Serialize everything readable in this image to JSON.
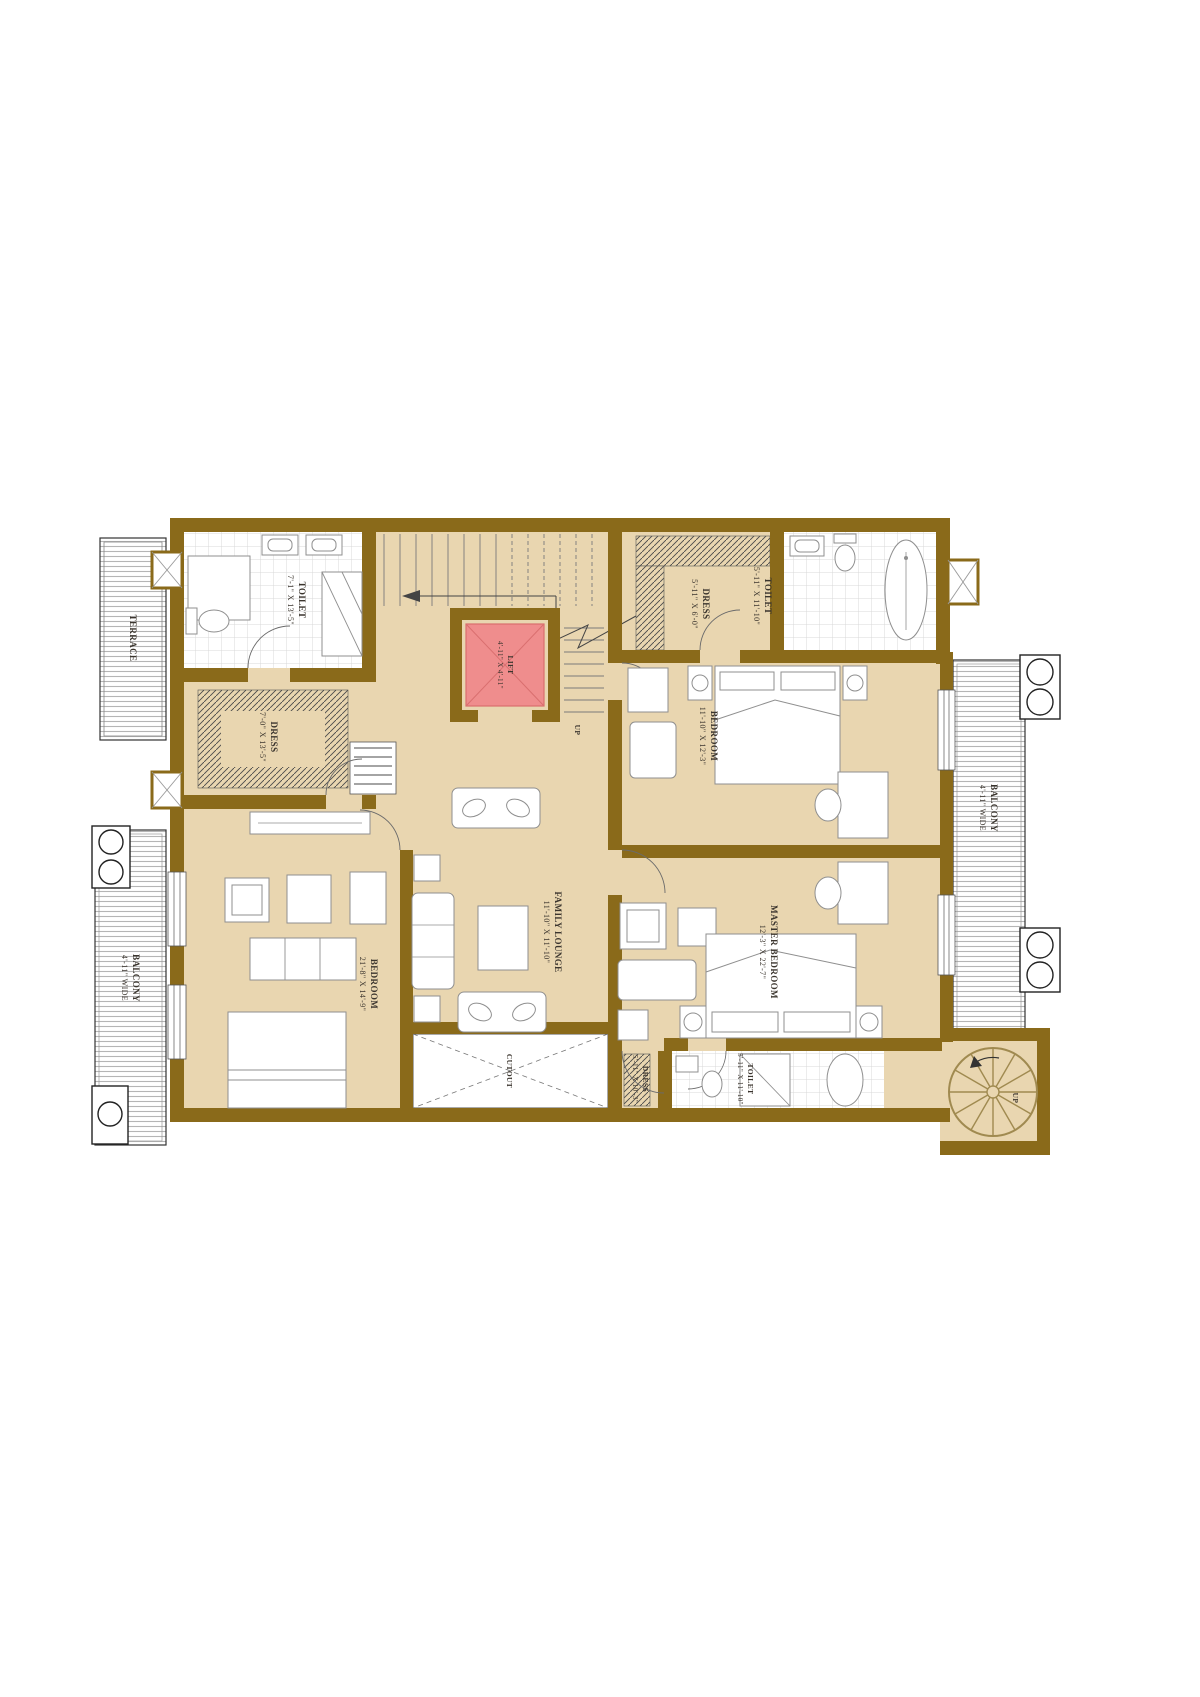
{
  "plan": {
    "type": "residential-floor-plan",
    "orientation_note": "plan rendered rotated 180 degrees (labels upside down)",
    "colors": {
      "wall": "#8a6a1a",
      "floor": "#e9d6b0",
      "lift_fill": "#ef8d8d",
      "lift_stroke": "#d96f6f",
      "deck_stripe": "#b5b5b5",
      "tile": "#d9d9d9",
      "furniture": "#8f8f8f",
      "label_text": "#3b352e"
    },
    "rooms": {
      "terrace": {
        "name": "TERRACE"
      },
      "toilet_tl": {
        "name": "TOILET",
        "dims": "7'-1\" X 13'-5\""
      },
      "dress_tl": {
        "name": "DRESS",
        "dims": "7'-0\" X 13'-5\""
      },
      "lift": {
        "name": "LIFT",
        "dims": "4'-11\" X 4'-11\""
      },
      "stairs": {
        "up": "UP"
      },
      "dress_tr": {
        "name": "DRESS",
        "dims": "5'-11\" X 6'-0\""
      },
      "toilet_tr": {
        "name": "TOILET",
        "dims": "5'-11\" X 11'-10\""
      },
      "bedroom_r": {
        "name": "BEDROOM",
        "dims": "11'-10\" X 12'-3\""
      },
      "balcony_r": {
        "name": "BALCONY",
        "dims": "4'-11\" WIDE"
      },
      "master": {
        "name": "MASTER BEDROOM",
        "dims": "12'-3\" X 22'-7\""
      },
      "lounge": {
        "name": "FAMILY LOUNGE",
        "dims": "11'-10\" X 11'-10\""
      },
      "bedroom_l": {
        "name": "BEDROOM",
        "dims": "21'-8\" X 14'-9\""
      },
      "cutout": {
        "name": "CUTOUT"
      },
      "dress_br": {
        "name": "DRESS",
        "dims": "5'-11\" X 10'-3\""
      },
      "toilet_br": {
        "name": "TOILET",
        "dims": "5'-11\" X 11'-10\""
      },
      "spiral_stair": {
        "up": "UP"
      },
      "balcony_l": {
        "name": "BALCONY",
        "dims": "4'-11\" WIDE"
      }
    }
  }
}
